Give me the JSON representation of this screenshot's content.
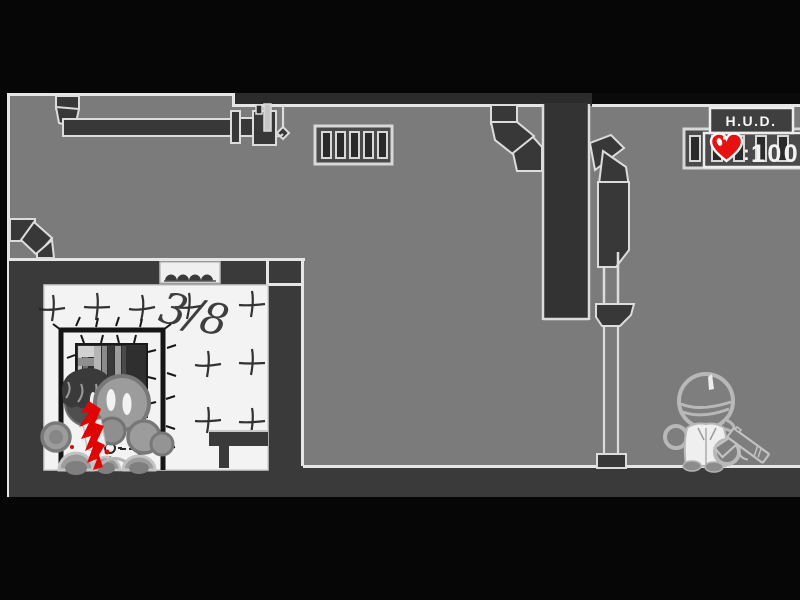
{
  "game": {
    "hud": {
      "title": "H.U.D.",
      "separator": ":",
      "health": "100",
      "heart_color": "#e81111"
    },
    "room": {
      "kill_tally": "3/8"
    },
    "colors": {
      "background_gray": "#7b7b7b",
      "structure_dark": "#3a3a3a",
      "outline_light": "#dcdcdc",
      "room_white": "#f3f3f3",
      "blood_red": "#e00505",
      "frame_black": "#060606"
    }
  }
}
